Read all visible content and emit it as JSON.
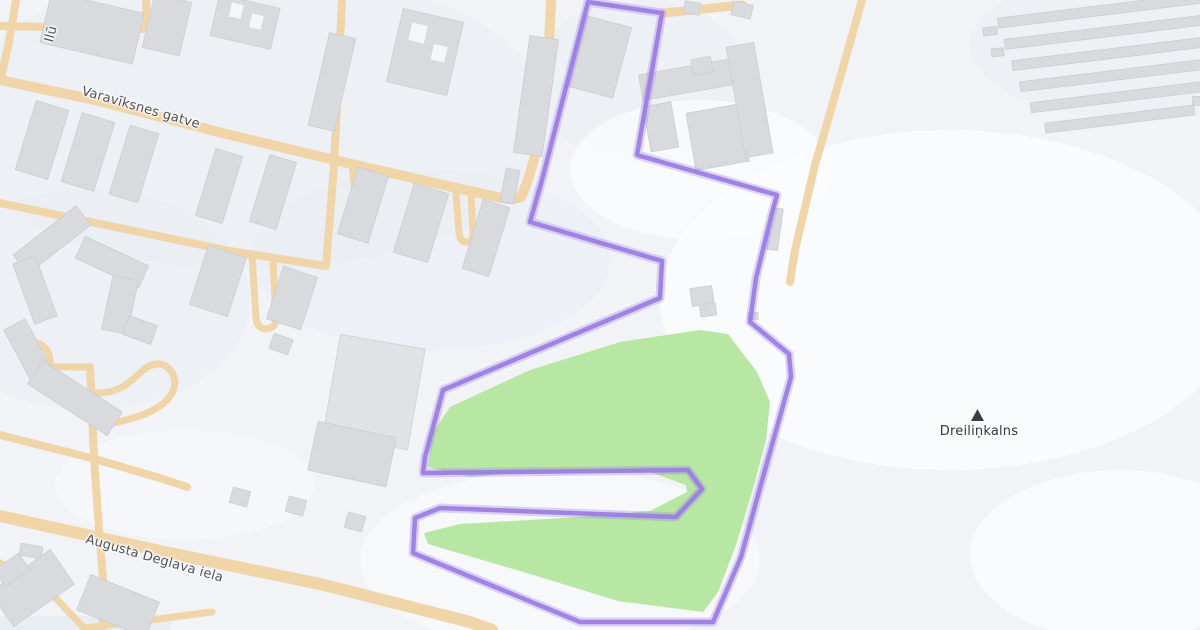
{
  "map": {
    "labels": {
      "street_top": {
        "text": "Varavīksnes gatve"
      },
      "street_bottom": {
        "text": "Augusta Deglava iela"
      },
      "street_left_partial": {
        "text": "Ilū"
      },
      "peak": {
        "text": "Dreiliņkalns"
      }
    },
    "icons": {
      "peak": "peak-icon"
    },
    "colors": {
      "background": "#f1f3f7",
      "road": "#f0d5a8",
      "building": "#d8dade",
      "building_light": "#e0e2e5",
      "green_area": "#b8e6a3",
      "boundary": "#9b7ce3",
      "label_text": "#4f4f58",
      "peak_icon": "#3d3d42"
    }
  }
}
